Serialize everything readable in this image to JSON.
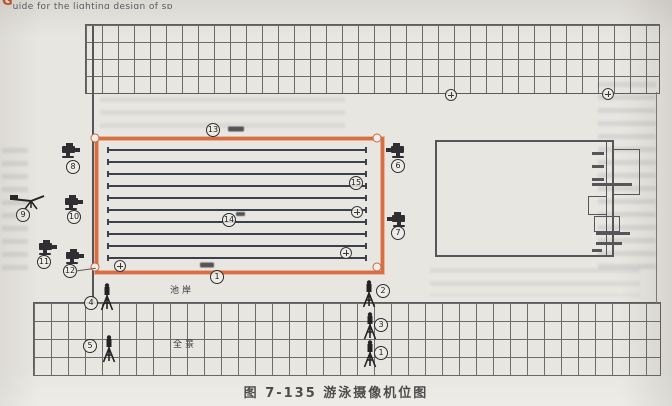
{
  "page": {
    "header_initial": "G",
    "header_text": "uide for the lighting design of sp",
    "caption": "图 7-135  游泳摄像机位图"
  },
  "colors": {
    "pool_border": "#d46f48",
    "header_accent": "#cc4a1d",
    "line_dark": "#3c404a"
  },
  "labels": [
    {
      "text": "池岸",
      "x": 170,
      "y": 283
    },
    {
      "text": "全景",
      "x": 173,
      "y": 337
    }
  ],
  "pool": {
    "left": 95,
    "top": 137,
    "width": 283,
    "height": 131,
    "lane_count": 10,
    "lane_ys": [
      149,
      161,
      173,
      185,
      197,
      209,
      221,
      233,
      245,
      257
    ]
  },
  "markers": [
    {
      "t": "camera",
      "x": 70,
      "y": 151,
      "dir": "right"
    },
    {
      "t": "num",
      "n": "8",
      "x": 73,
      "y": 167
    },
    {
      "t": "crane",
      "x": 28,
      "y": 201
    },
    {
      "t": "num",
      "n": "9",
      "x": 23,
      "y": 215
    },
    {
      "t": "camera",
      "x": 73,
      "y": 203,
      "dir": "right"
    },
    {
      "t": "num",
      "n": "10",
      "x": 74,
      "y": 217
    },
    {
      "t": "camera",
      "x": 47,
      "y": 248,
      "dir": "right"
    },
    {
      "t": "num",
      "n": "11",
      "x": 44,
      "y": 262
    },
    {
      "t": "camera",
      "x": 74,
      "y": 257,
      "dir": "right"
    },
    {
      "t": "num",
      "n": "12",
      "x": 70,
      "y": 271
    },
    {
      "t": "line",
      "x": 76,
      "y": 271,
      "len": 20,
      "deg": -8
    },
    {
      "t": "camera",
      "x": 396,
      "y": 151,
      "dir": "left"
    },
    {
      "t": "num",
      "n": "6",
      "x": 398,
      "y": 166
    },
    {
      "t": "camera",
      "x": 397,
      "y": 220,
      "dir": "left"
    },
    {
      "t": "num",
      "n": "7",
      "x": 398,
      "y": 233
    },
    {
      "t": "num",
      "n": "13",
      "x": 213,
      "y": 130
    },
    {
      "t": "smudge",
      "x": 228,
      "y": 129,
      "w": 16,
      "h": 5
    },
    {
      "t": "num",
      "n": "14",
      "x": 229,
      "y": 220
    },
    {
      "t": "smudge",
      "x": 236,
      "y": 214,
      "w": 9,
      "h": 4
    },
    {
      "t": "num",
      "n": "15",
      "x": 356,
      "y": 183
    },
    {
      "t": "target",
      "x": 357,
      "y": 212
    },
    {
      "t": "target",
      "x": 346,
      "y": 253
    },
    {
      "t": "target",
      "x": 120,
      "y": 266
    },
    {
      "t": "num",
      "n": "1",
      "x": 217,
      "y": 277
    },
    {
      "t": "smudge",
      "x": 200,
      "y": 265,
      "w": 14,
      "h": 5
    },
    {
      "t": "target",
      "x": 451,
      "y": 95
    },
    {
      "t": "target",
      "x": 608,
      "y": 94
    },
    {
      "t": "tripod",
      "x": 107,
      "y": 297
    },
    {
      "t": "num",
      "n": "4",
      "x": 91,
      "y": 303
    },
    {
      "t": "tripod",
      "x": 109,
      "y": 349
    },
    {
      "t": "num",
      "n": "5",
      "x": 90,
      "y": 346
    },
    {
      "t": "tripod",
      "x": 369,
      "y": 294
    },
    {
      "t": "num",
      "n": "2",
      "x": 383,
      "y": 291
    },
    {
      "t": "tripod",
      "x": 370,
      "y": 326
    },
    {
      "t": "num",
      "n": "3",
      "x": 381,
      "y": 325
    },
    {
      "t": "tripod",
      "x": 370,
      "y": 354
    },
    {
      "t": "num",
      "n": "1",
      "x": 381,
      "y": 353
    }
  ]
}
